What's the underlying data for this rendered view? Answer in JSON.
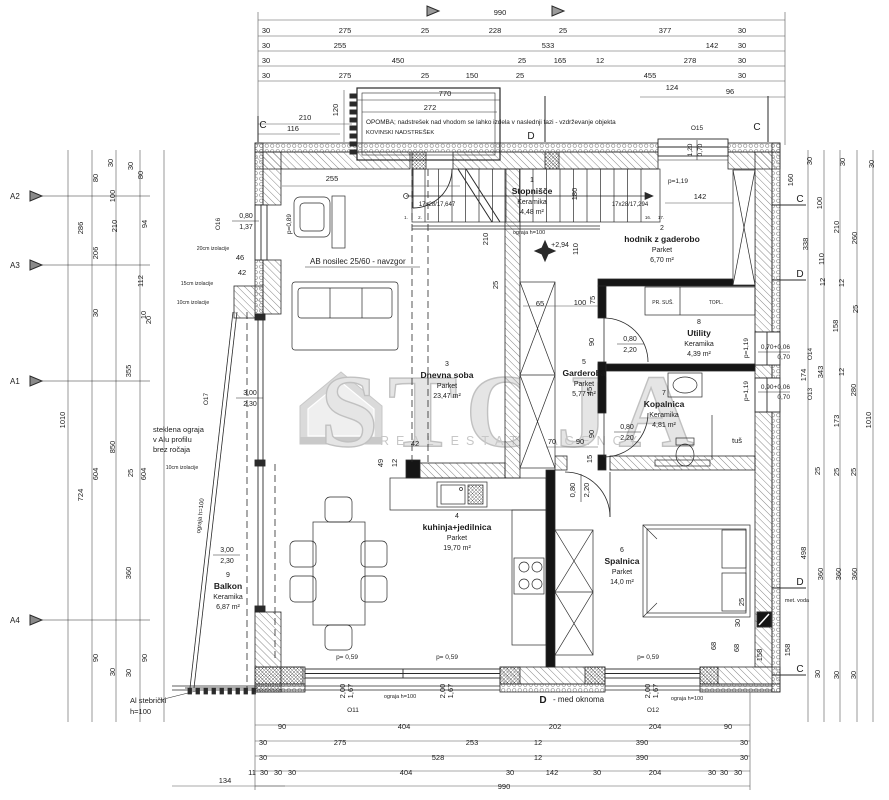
{
  "watermark": {
    "word": "STOJA",
    "subtitle": "REAL ESTATE AGENCY",
    "logo_name": "house-logo",
    "color": "#c7c7c7"
  },
  "note": {
    "line1": "OPOMBA; nadstrešek nad vhodom se lahko izdela v naslednji fazi - vzdrževanje objekta",
    "line2": "KOVINSKI NADSTREŠEK"
  },
  "rooms": [
    {
      "num": "1",
      "name": "Stopnišče",
      "material": "Keramika",
      "area": "4,48 m²",
      "x": 532,
      "y": 182
    },
    {
      "num": "2",
      "name": "hodnik z gaderobo",
      "material": "Parket",
      "area": "6,70  m²",
      "x": 662,
      "y": 230
    },
    {
      "num": "3",
      "name": "Dnevna soba",
      "material": "Parket",
      "area": "23,47 m²",
      "x": 447,
      "y": 366
    },
    {
      "num": "4",
      "name": "kuhinja+jedilnica",
      "material": "Parket",
      "area": "19,70 m²",
      "x": 457,
      "y": 518
    },
    {
      "num": "5",
      "name": "Garderoba",
      "material": "Parket",
      "area": "5,77 m²",
      "x": 584,
      "y": 364
    },
    {
      "num": "6",
      "name": "Spalnica",
      "material": "Parket",
      "area": "14,0  m²",
      "x": 622,
      "y": 552
    },
    {
      "num": "7",
      "name": "Kopalnica",
      "material": "Keramika",
      "area": "4,81 m²",
      "x": 664,
      "y": 395
    },
    {
      "num": "8",
      "name": "Utility",
      "material": "Keramika",
      "area": "4,39 m²",
      "x": 699,
      "y": 324
    },
    {
      "num": "9",
      "name": "Balkon",
      "material": "Keramika",
      "area": "6,87 m²",
      "x": 228,
      "y": 577
    }
  ],
  "dims_top": [
    {
      "t": "990",
      "x": 500,
      "y": 15
    },
    {
      "t": "30",
      "x": 266,
      "y": 33
    },
    {
      "t": "275",
      "x": 345,
      "y": 33
    },
    {
      "t": "25",
      "x": 425,
      "y": 33
    },
    {
      "t": "228",
      "x": 495,
      "y": 33
    },
    {
      "t": "25",
      "x": 563,
      "y": 33
    },
    {
      "t": "377",
      "x": 665,
      "y": 33
    },
    {
      "t": "30",
      "x": 742,
      "y": 33
    },
    {
      "t": "30",
      "x": 266,
      "y": 48
    },
    {
      "t": "255",
      "x": 340,
      "y": 48
    },
    {
      "t": "533",
      "x": 548,
      "y": 48
    },
    {
      "t": "142",
      "x": 712,
      "y": 48
    },
    {
      "t": "30",
      "x": 742,
      "y": 48
    },
    {
      "t": "30",
      "x": 266,
      "y": 63
    },
    {
      "t": "450",
      "x": 398,
      "y": 63
    },
    {
      "t": "25",
      "x": 522,
      "y": 63
    },
    {
      "t": "165",
      "x": 560,
      "y": 63
    },
    {
      "t": "12",
      "x": 600,
      "y": 63
    },
    {
      "t": "278",
      "x": 690,
      "y": 63
    },
    {
      "t": "30",
      "x": 742,
      "y": 63
    },
    {
      "t": "30",
      "x": 266,
      "y": 78
    },
    {
      "t": "275",
      "x": 345,
      "y": 78
    },
    {
      "t": "25",
      "x": 425,
      "y": 78
    },
    {
      "t": "150",
      "x": 472,
      "y": 78
    },
    {
      "t": "25",
      "x": 520,
      "y": 78
    },
    {
      "t": "455",
      "x": 650,
      "y": 78
    },
    {
      "t": "30",
      "x": 742,
      "y": 78
    },
    {
      "t": "770",
      "x": 445,
      "y": 96
    },
    {
      "t": "124",
      "x": 672,
      "y": 90
    },
    {
      "t": "96",
      "x": 730,
      "y": 94
    },
    {
      "t": "272",
      "x": 430,
      "y": 110
    },
    {
      "t": "210",
      "x": 305,
      "y": 120
    },
    {
      "t": "116",
      "x": 293,
      "y": 131
    },
    {
      "t": "120",
      "x": 338,
      "y": 110,
      "r": -90
    },
    {
      "t": "255",
      "x": 332,
      "y": 181
    },
    {
      "t": "142",
      "x": 700,
      "y": 199
    }
  ],
  "dims_bottom": [
    {
      "t": "90",
      "x": 282,
      "y": 729
    },
    {
      "t": "404",
      "x": 404,
      "y": 729
    },
    {
      "t": "202",
      "x": 555,
      "y": 729
    },
    {
      "t": "204",
      "x": 655,
      "y": 729
    },
    {
      "t": "90",
      "x": 728,
      "y": 729
    },
    {
      "t": "30",
      "x": 263,
      "y": 745
    },
    {
      "t": "275",
      "x": 340,
      "y": 745
    },
    {
      "t": "253",
      "x": 472,
      "y": 745
    },
    {
      "t": "12",
      "x": 538,
      "y": 745
    },
    {
      "t": "390",
      "x": 642,
      "y": 745
    },
    {
      "t": "30",
      "x": 744,
      "y": 745
    },
    {
      "t": "30",
      "x": 263,
      "y": 760
    },
    {
      "t": "528",
      "x": 438,
      "y": 760
    },
    {
      "t": "12",
      "x": 538,
      "y": 760
    },
    {
      "t": "390",
      "x": 642,
      "y": 760
    },
    {
      "t": "30",
      "x": 744,
      "y": 760
    },
    {
      "t": "11",
      "x": 252,
      "y": 775
    },
    {
      "t": "30",
      "x": 264,
      "y": 775
    },
    {
      "t": "30",
      "x": 278,
      "y": 775
    },
    {
      "t": "30",
      "x": 292,
      "y": 775
    },
    {
      "t": "404",
      "x": 406,
      "y": 775
    },
    {
      "t": "30",
      "x": 510,
      "y": 775
    },
    {
      "t": "142",
      "x": 552,
      "y": 775
    },
    {
      "t": "30",
      "x": 597,
      "y": 775
    },
    {
      "t": "204",
      "x": 655,
      "y": 775
    },
    {
      "t": "30",
      "x": 712,
      "y": 775
    },
    {
      "t": "30",
      "x": 724,
      "y": 775
    },
    {
      "t": "30",
      "x": 738,
      "y": 775
    },
    {
      "t": "134",
      "x": 225,
      "y": 783
    },
    {
      "t": "990",
      "x": 504,
      "y": 789
    }
  ],
  "dims_left": [
    {
      "t": "1010",
      "x": 65,
      "y": 420,
      "r": -90
    },
    {
      "t": "286",
      "x": 83,
      "y": 228,
      "r": -90
    },
    {
      "t": "724",
      "x": 83,
      "y": 495,
      "r": -90
    },
    {
      "t": "80",
      "x": 98,
      "y": 178,
      "r": -90
    },
    {
      "t": "206",
      "x": 98,
      "y": 253,
      "r": -90
    },
    {
      "t": "30",
      "x": 98,
      "y": 313,
      "r": -90
    },
    {
      "t": "604",
      "x": 98,
      "y": 474,
      "r": -90
    },
    {
      "t": "90",
      "x": 98,
      "y": 658,
      "r": -90
    },
    {
      "t": "30",
      "x": 113,
      "y": 163,
      "r": -90
    },
    {
      "t": "100",
      "x": 115,
      "y": 196,
      "r": -90
    },
    {
      "t": "210",
      "x": 117,
      "y": 226,
      "r": -90
    },
    {
      "t": "850",
      "x": 115,
      "y": 447,
      "r": -90
    },
    {
      "t": "30",
      "x": 115,
      "y": 672,
      "r": -90
    },
    {
      "t": "30",
      "x": 133,
      "y": 166,
      "r": -90
    },
    {
      "t": "80",
      "x": 143,
      "y": 175,
      "r": -90
    },
    {
      "t": "94",
      "x": 147,
      "y": 224,
      "r": -90
    },
    {
      "t": "112",
      "x": 143,
      "y": 281,
      "r": -90
    },
    {
      "t": "10",
      "x": 146,
      "y": 315,
      "r": -90
    },
    {
      "t": "20",
      "x": 151,
      "y": 320,
      "r": -90
    },
    {
      "t": "355",
      "x": 131,
      "y": 371,
      "r": -90
    },
    {
      "t": "25",
      "x": 133,
      "y": 473,
      "r": -90
    },
    {
      "t": "604",
      "x": 146,
      "y": 474,
      "r": -90
    },
    {
      "t": "360",
      "x": 131,
      "y": 573,
      "r": -90
    },
    {
      "t": "30",
      "x": 131,
      "y": 673,
      "r": -90
    },
    {
      "t": "90",
      "x": 147,
      "y": 658,
      "r": -90
    }
  ],
  "dims_right": [
    {
      "t": "30",
      "x": 812,
      "y": 161,
      "r": -90
    },
    {
      "t": "30",
      "x": 845,
      "y": 162,
      "r": -90
    },
    {
      "t": "30",
      "x": 874,
      "y": 164,
      "r": -90
    },
    {
      "t": "160",
      "x": 793,
      "y": 180,
      "r": -90
    },
    {
      "t": "100",
      "x": 822,
      "y": 203,
      "r": -90
    },
    {
      "t": "210",
      "x": 839,
      "y": 227,
      "r": -90
    },
    {
      "t": "260",
      "x": 857,
      "y": 238,
      "r": -90
    },
    {
      "t": "338",
      "x": 808,
      "y": 244,
      "r": -90
    },
    {
      "t": "110",
      "x": 824,
      "y": 259,
      "r": -90
    },
    {
      "t": "12",
      "x": 825,
      "y": 282,
      "r": -90
    },
    {
      "t": "12",
      "x": 844,
      "y": 283,
      "r": -90
    },
    {
      "t": "25",
      "x": 858,
      "y": 309,
      "r": -90
    },
    {
      "t": "158",
      "x": 838,
      "y": 326,
      "r": -90
    },
    {
      "t": "343",
      "x": 823,
      "y": 372,
      "r": -90
    },
    {
      "t": "174",
      "x": 806,
      "y": 375,
      "r": -90
    },
    {
      "t": "12",
      "x": 844,
      "y": 372,
      "r": -90
    },
    {
      "t": "280",
      "x": 856,
      "y": 390,
      "r": -90
    },
    {
      "t": "173",
      "x": 839,
      "y": 421,
      "r": -90
    },
    {
      "t": "1010",
      "x": 871,
      "y": 420,
      "r": -90
    },
    {
      "t": "25",
      "x": 820,
      "y": 471,
      "r": -90
    },
    {
      "t": "25",
      "x": 839,
      "y": 472,
      "r": -90
    },
    {
      "t": "25",
      "x": 856,
      "y": 472,
      "r": -90
    },
    {
      "t": "498",
      "x": 806,
      "y": 553,
      "r": -90
    },
    {
      "t": "360",
      "x": 823,
      "y": 574,
      "r": -90
    },
    {
      "t": "360",
      "x": 841,
      "y": 574,
      "r": -90
    },
    {
      "t": "360",
      "x": 857,
      "y": 574,
      "r": -90
    },
    {
      "t": "25",
      "x": 744,
      "y": 602,
      "r": -90
    },
    {
      "t": "30",
      "x": 740,
      "y": 623,
      "r": -90
    },
    {
      "t": "68",
      "x": 739,
      "y": 648,
      "r": -90
    },
    {
      "t": "158",
      "x": 790,
      "y": 650,
      "r": -90
    },
    {
      "t": "30",
      "x": 820,
      "y": 674,
      "r": -90
    },
    {
      "t": "30",
      "x": 839,
      "y": 675,
      "r": -90
    },
    {
      "t": "30",
      "x": 856,
      "y": 675,
      "r": -90
    },
    {
      "t": "68",
      "x": 716,
      "y": 646,
      "r": -90
    },
    {
      "t": "158",
      "x": 762,
      "y": 655,
      "r": -90
    }
  ],
  "dims_inner": [
    {
      "t": "210",
      "x": 488,
      "y": 239,
      "r": -90
    },
    {
      "t": "180",
      "x": 577,
      "y": 194,
      "r": -90
    },
    {
      "t": "110",
      "x": 578,
      "y": 249,
      "r": -90
    },
    {
      "t": "25",
      "x": 498,
      "y": 285,
      "r": -90
    },
    {
      "t": "65",
      "x": 540,
      "y": 306
    },
    {
      "t": "100",
      "x": 580,
      "y": 305
    },
    {
      "t": "75",
      "x": 595,
      "y": 300,
      "r": -90
    },
    {
      "t": "90",
      "x": 594,
      "y": 342,
      "r": -90
    },
    {
      "t": "90",
      "x": 594,
      "y": 434,
      "r": -90
    },
    {
      "t": "45",
      "x": 592,
      "y": 391,
      "r": -90
    },
    {
      "t": "15",
      "x": 592,
      "y": 459,
      "r": -90
    },
    {
      "t": "70",
      "x": 552,
      "y": 444
    },
    {
      "t": "90",
      "x": 580,
      "y": 444
    },
    {
      "t": "49",
      "x": 383,
      "y": 463,
      "r": -90
    },
    {
      "t": "12",
      "x": 397,
      "y": 463,
      "r": -90
    },
    {
      "t": "42",
      "x": 415,
      "y": 446
    },
    {
      "t": "0,80",
      "x": 575,
      "y": 490,
      "r": -90
    },
    {
      "t": "2,20",
      "x": 589,
      "y": 490,
      "r": -90
    },
    {
      "t": "2,00",
      "x": 345,
      "y": 691,
      "r": -90
    },
    {
      "t": "1,67",
      "x": 353,
      "y": 691,
      "r": -90
    },
    {
      "t": "2,00",
      "x": 445,
      "y": 691,
      "r": -90
    },
    {
      "t": "1,67",
      "x": 453,
      "y": 691,
      "r": -90
    },
    {
      "t": "2,00",
      "x": 650,
      "y": 691,
      "r": -90
    },
    {
      "t": "1,67",
      "x": 658,
      "y": 691,
      "r": -90
    },
    {
      "t": "46",
      "x": 240,
      "y": 260
    },
    {
      "t": "42",
      "x": 242,
      "y": 275
    }
  ],
  "labels": [
    {
      "t": "OPOMBA; nadstrešek nad vhodom se lahko izdela v naslednji fazi - vzdrževanje objekta",
      "x": 366,
      "y": 124,
      "s": 6.4,
      "a": "s"
    },
    {
      "t": "KOVINSKI NADSTREŠEK",
      "x": 366,
      "y": 134,
      "s": 5.8,
      "a": "s"
    },
    {
      "t": "AB nosilec 25/60 - navzgor",
      "x": 310,
      "y": 264,
      "s": 8,
      "a": "s"
    },
    {
      "t": "steklena ograja",
      "x": 153,
      "y": 432,
      "s": 7.5,
      "a": "s"
    },
    {
      "t": "v Alu profilu",
      "x": 153,
      "y": 442,
      "s": 7.5,
      "a": "s"
    },
    {
      "t": "brez ročaja",
      "x": 153,
      "y": 452,
      "s": 7.5,
      "a": "s"
    },
    {
      "t": "ograja h=100",
      "x": 529,
      "y": 234,
      "s": 5.5
    },
    {
      "t": "ograja h=100",
      "x": 400,
      "y": 698,
      "s": 5.5
    },
    {
      "t": "ograja h=100",
      "x": 687,
      "y": 700,
      "s": 5.5
    },
    {
      "t": "ograja h=100",
      "x": 202,
      "y": 516,
      "s": 6,
      "r": -84
    },
    {
      "t": "Al stebrički",
      "x": 130,
      "y": 703,
      "s": 7.5,
      "a": "s"
    },
    {
      "t": "h=100",
      "x": 130,
      "y": 714,
      "s": 7.5,
      "a": "s"
    },
    {
      "t": "D",
      "x": 543,
      "y": 703,
      "s": 10,
      "b": 1
    },
    {
      "t": "- med oknoma",
      "x": 553,
      "y": 702,
      "s": 8,
      "a": "s"
    },
    {
      "t": "met. voda",
      "x": 797,
      "y": 602,
      "s": 5.5
    },
    {
      "t": "tuš",
      "x": 737,
      "y": 443,
      "s": 7.5
    },
    {
      "t": "PR. SUŠ.",
      "x": 663,
      "y": 304,
      "s": 5
    },
    {
      "t": "TOPL.",
      "x": 716,
      "y": 304,
      "s": 5
    },
    {
      "t": "20cm izolacije",
      "x": 213,
      "y": 250,
      "s": 5.2
    },
    {
      "t": "15cm izolacije",
      "x": 197,
      "y": 285,
      "s": 5.2
    },
    {
      "t": "10cm izolacije",
      "x": 193,
      "y": 304,
      "s": 5.2
    },
    {
      "t": "10cm izolacije",
      "x": 182,
      "y": 469,
      "s": 5.2
    },
    {
      "t": "+2,94",
      "x": 560,
      "y": 247,
      "s": 7
    },
    {
      "t": "17x28/17,647",
      "x": 437,
      "y": 206,
      "s": 6
    },
    {
      "t": "17x28/17,294",
      "x": 630,
      "y": 206,
      "s": 6
    },
    {
      "t": "1.",
      "x": 406,
      "y": 219,
      "s": 4.5
    },
    {
      "t": "2.",
      "x": 420,
      "y": 219,
      "s": 4.5
    },
    {
      "t": "16.",
      "x": 648,
      "y": 219,
      "s": 4.5
    },
    {
      "t": "17.",
      "x": 661,
      "y": 219,
      "s": 4.5
    },
    {
      "t": "O16",
      "x": 220,
      "y": 224,
      "s": 6.5,
      "r": -90
    },
    {
      "t": "0,80",
      "x": 246,
      "y": 218,
      "s": 7
    },
    {
      "t": "1,37",
      "x": 246,
      "y": 229,
      "s": 7
    },
    {
      "t": "O17",
      "x": 208,
      "y": 399,
      "s": 6.5,
      "r": -90
    },
    {
      "t": "3,00",
      "x": 250,
      "y": 395,
      "s": 7
    },
    {
      "t": "2,30",
      "x": 250,
      "y": 406,
      "s": 7
    },
    {
      "t": "3,00",
      "x": 227,
      "y": 552,
      "s": 7
    },
    {
      "t": "2,30",
      "x": 227,
      "y": 563,
      "s": 7
    },
    {
      "t": "O15",
      "x": 697,
      "y": 130,
      "s": 6.5
    },
    {
      "t": "1,20",
      "x": 692,
      "y": 150,
      "s": 6.5,
      "r": -90
    },
    {
      "t": "0,70",
      "x": 702,
      "y": 150,
      "s": 6.5,
      "r": -90
    },
    {
      "t": "O14",
      "x": 812,
      "y": 354,
      "s": 6.5,
      "r": -90
    },
    {
      "t": "0,70+0,06",
      "x": 790,
      "y": 349,
      "s": 6.5,
      "a": "e"
    },
    {
      "t": "0,70",
      "x": 790,
      "y": 359,
      "s": 6.5,
      "a": "e"
    },
    {
      "t": "O13",
      "x": 812,
      "y": 394,
      "s": 6.5,
      "r": -90
    },
    {
      "t": "0,90+0,06",
      "x": 790,
      "y": 389,
      "s": 6.5,
      "a": "e"
    },
    {
      "t": "0,70",
      "x": 790,
      "y": 399,
      "s": 6.5,
      "a": "e"
    },
    {
      "t": "O11",
      "x": 353,
      "y": 712,
      "s": 6.5
    },
    {
      "t": "O12",
      "x": 653,
      "y": 712,
      "s": 6.5
    },
    {
      "t": "p=0,89",
      "x": 291,
      "y": 224,
      "s": 6.5,
      "r": -90
    },
    {
      "t": "p=1,19",
      "x": 678,
      "y": 183,
      "s": 6.5
    },
    {
      "t": "p=1,19",
      "x": 748,
      "y": 348,
      "s": 6.5,
      "r": -90
    },
    {
      "t": "p=1,19",
      "x": 748,
      "y": 391,
      "s": 6.5,
      "r": -90
    },
    {
      "t": "p= 0,59",
      "x": 347,
      "y": 659,
      "s": 6.5
    },
    {
      "t": "p= 0,59",
      "x": 447,
      "y": 659,
      "s": 6.5
    },
    {
      "t": "p= 0,59",
      "x": 648,
      "y": 659,
      "s": 6.5
    },
    {
      "t": "0,80",
      "x": 630,
      "y": 341,
      "s": 7
    },
    {
      "t": "2,20",
      "x": 630,
      "y": 352,
      "s": 7
    },
    {
      "t": "0,80",
      "x": 627,
      "y": 429,
      "s": 7
    },
    {
      "t": "2,20",
      "x": 627,
      "y": 440,
      "s": 7
    },
    {
      "t": "C",
      "x": 263,
      "y": 128,
      "s": 10
    },
    {
      "t": "C",
      "x": 757,
      "y": 130,
      "s": 10
    },
    {
      "t": "D",
      "x": 531,
      "y": 139,
      "s": 10
    },
    {
      "t": "C",
      "x": 800,
      "y": 202,
      "s": 10
    },
    {
      "t": "D",
      "x": 800,
      "y": 277,
      "s": 10
    },
    {
      "t": "D",
      "x": 800,
      "y": 585,
      "s": 10
    },
    {
      "t": "C",
      "x": 800,
      "y": 672,
      "s": 10
    },
    {
      "t": "A2",
      "x": 10,
      "y": 199,
      "s": 8,
      "a": "s"
    },
    {
      "t": "A3",
      "x": 10,
      "y": 268,
      "s": 8,
      "a": "s"
    },
    {
      "t": "A1",
      "x": 10,
      "y": 384,
      "s": 8,
      "a": "s"
    },
    {
      "t": "A4",
      "x": 10,
      "y": 623,
      "s": 8,
      "a": "s"
    }
  ]
}
